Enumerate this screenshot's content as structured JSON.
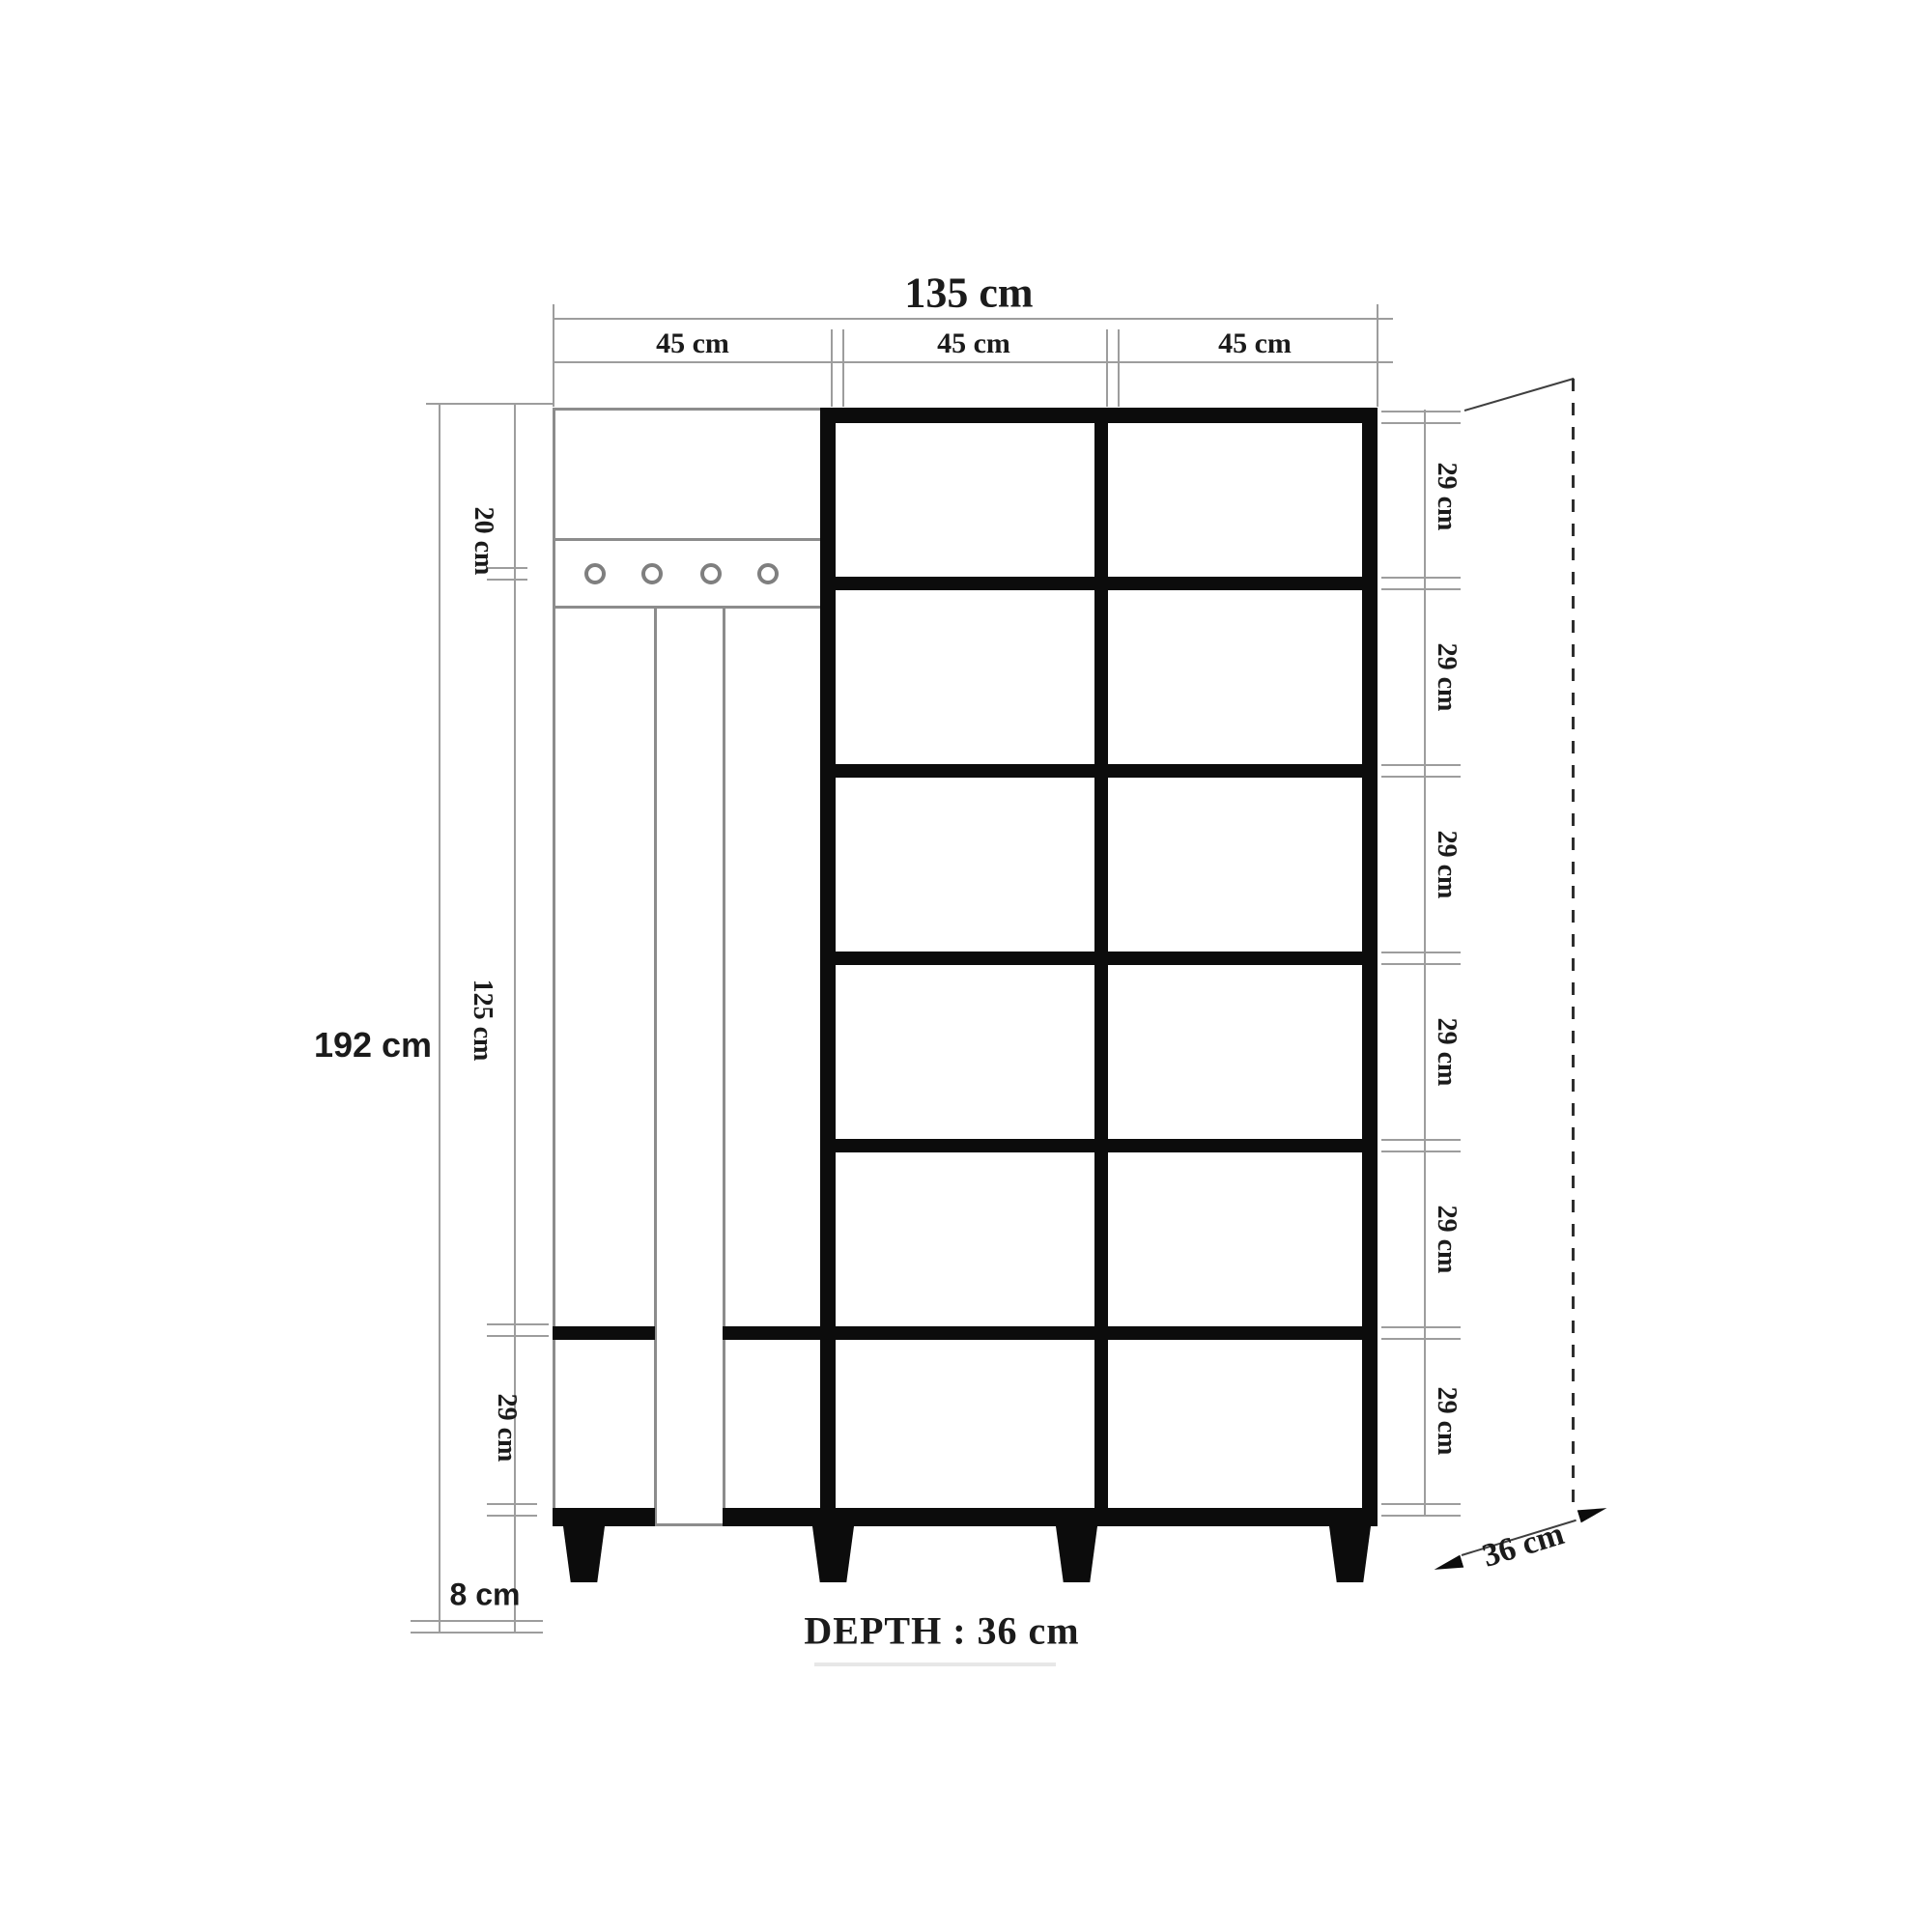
{
  "dims": {
    "width_total": "135 cm",
    "width_sections": [
      "45 cm",
      "45 cm",
      "45 cm"
    ],
    "height_total": "192 cm",
    "height_segments": [
      "20 cm",
      "125 cm",
      "29 cm",
      "8 cm"
    ],
    "row_heights": [
      "29 cm",
      "29 cm",
      "29 cm",
      "29 cm",
      "29 cm",
      "29 cm"
    ],
    "depth_size": "36 cm",
    "depth_note": "DEPTH : 36 cm"
  },
  "colors": {
    "ink": "#1b1b1b",
    "furniture_black": "#0c0c0c",
    "thin_line": "#8c8c8c",
    "dim_line": "#9d9d9d"
  }
}
